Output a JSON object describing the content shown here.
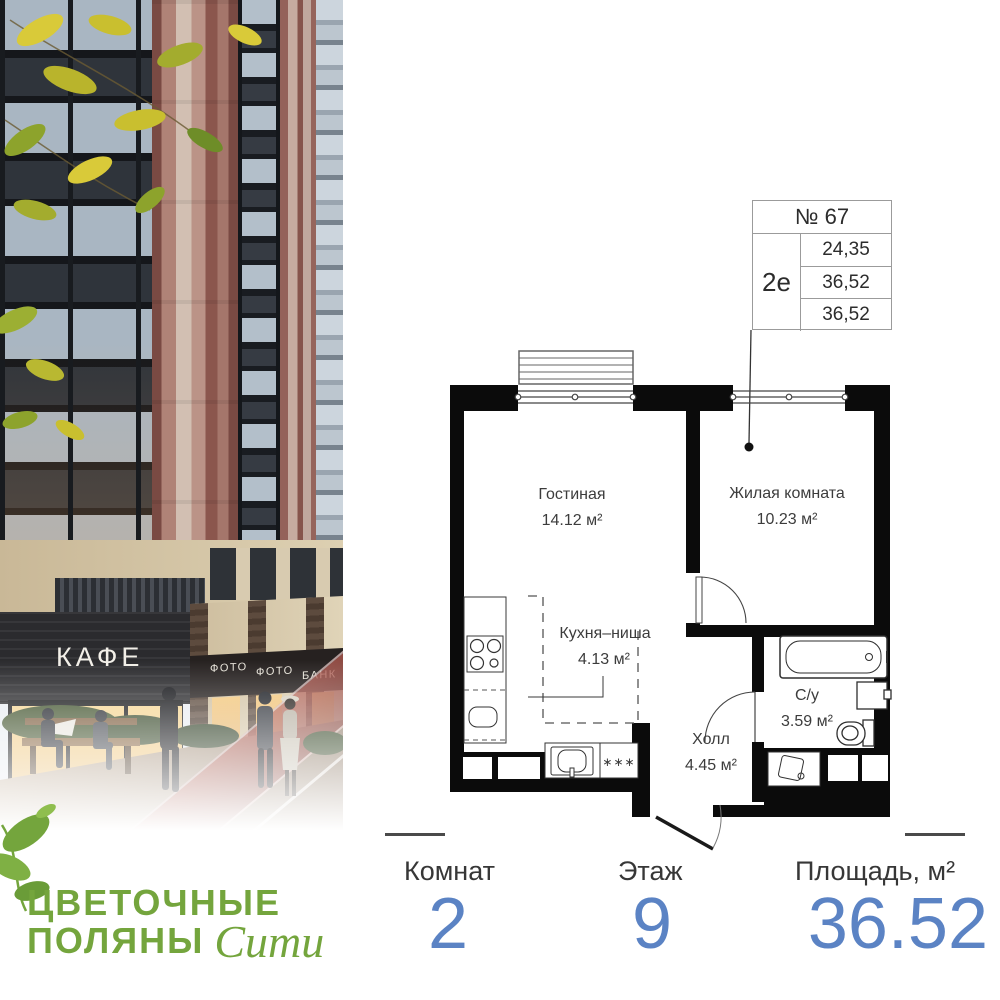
{
  "photo": {
    "cafe_sign": "КАФЕ",
    "signs": [
      "ФОТО",
      "ФОТО",
      "БАНК"
    ]
  },
  "logo": {
    "line1": "ЦВЕТОЧНЫЕ",
    "line2": "ПОЛЯНЫ",
    "script": "Сити",
    "color": "#74a53d"
  },
  "unit_card": {
    "number": "№ 67",
    "plan_type": "2е",
    "area_rows": [
      "24,35",
      "36,52",
      "36,52"
    ]
  },
  "floor_plan": {
    "rooms": {
      "living": {
        "name": "Гостиная",
        "area": "14.12 м²"
      },
      "bedroom": {
        "name": "Жилая комната",
        "area": "10.23 м²"
      },
      "kitchen": {
        "name": "Кухня–ниша",
        "area": "4.13 м²"
      },
      "hall": {
        "name": "Холл",
        "area": "4.45 м²"
      },
      "bathroom": {
        "name": "С/у",
        "area": "3.59 м²"
      }
    },
    "washer_marker": "∗∗∗"
  },
  "stats": {
    "items": [
      {
        "label": "Комнат",
        "value": "2"
      },
      {
        "label": "Этаж",
        "value": "9"
      },
      {
        "label": "Площадь, м²",
        "value": "36.52"
      }
    ],
    "value_color": "#5b83c4"
  }
}
